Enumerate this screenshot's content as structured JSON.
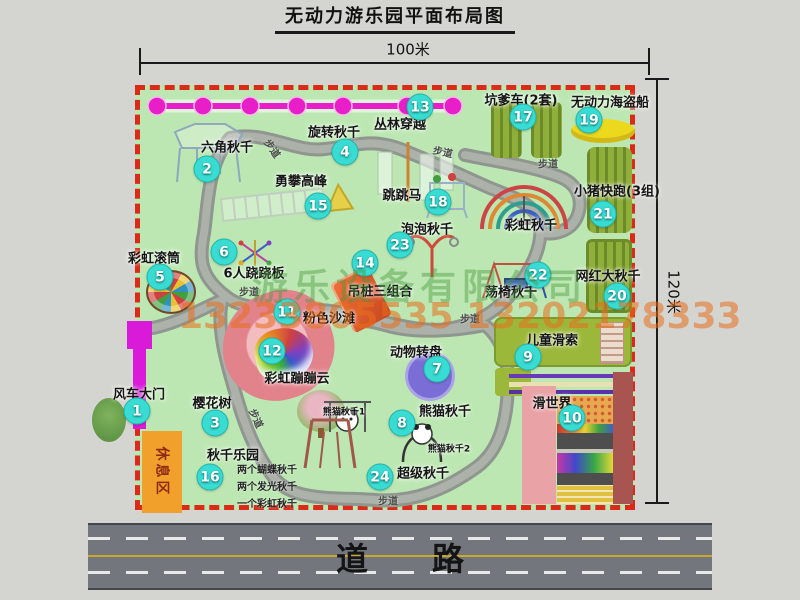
{
  "title": "无动力游乐园平面布局图",
  "dimension_labels": {
    "top": "100米",
    "right": "120米"
  },
  "road": {
    "label": "道路"
  },
  "walkway_label": "步道",
  "rest_area_label": "休息区",
  "rainbow_swing_label": "彩虹秋千",
  "panda_swing_sub_labels": [
    "熊猫秋千1",
    "熊猫秋千2"
  ],
  "swing_park_notes": [
    "两个蝴蝶秋千",
    "两个发光秋千",
    "一个彩虹秋千"
  ],
  "watermark": {
    "company": "游乐设备有限公司",
    "phone": "13233805535 13202178333"
  },
  "attractions": [
    {
      "num": "1",
      "name": "风车大门"
    },
    {
      "num": "2",
      "name": "六角秋千"
    },
    {
      "num": "3",
      "name": "樱花树"
    },
    {
      "num": "4",
      "name": "旋转秋千"
    },
    {
      "num": "5",
      "name": "彩虹滚筒"
    },
    {
      "num": "6",
      "name": "6人跷跷板"
    },
    {
      "num": "7",
      "name": "动物转盘"
    },
    {
      "num": "8",
      "name": "熊猫秋千"
    },
    {
      "num": "9",
      "name": "儿童滑索"
    },
    {
      "num": "10",
      "name": "滑世界"
    },
    {
      "num": "11",
      "name": "粉色沙滩"
    },
    {
      "num": "12",
      "name": "彩虹蹦蹦云"
    },
    {
      "num": "13",
      "name": "丛林穿越"
    },
    {
      "num": "14",
      "name": "吊桩三组合"
    },
    {
      "num": "15",
      "name": "勇攀高峰"
    },
    {
      "num": "16",
      "name": "秋千乐园"
    },
    {
      "num": "17",
      "name": "坑爹车(2套)"
    },
    {
      "num": "18",
      "name": "跳跳马"
    },
    {
      "num": "19",
      "name": "无动力海盗船"
    },
    {
      "num": "20",
      "name": "网红大秋千"
    },
    {
      "num": "21",
      "name": "小猪快跑(3组)"
    },
    {
      "num": "22",
      "name": "荡椅秋千"
    },
    {
      "num": "23",
      "name": "泡泡秋千"
    },
    {
      "num": "24",
      "name": "超级秋千"
    }
  ],
  "colors": {
    "map_bg": "#bce7b2",
    "border_red": "#dc2a18",
    "badge_cyan": "#38dcd2",
    "chain_magenta": "#e81fc8",
    "gate_magenta": "#d91ad9",
    "rest_orange": "#f2a02c",
    "equipment_olive": "#8fae3a",
    "pirate_ship_yellow": "#ecd91e",
    "carousel_purple": "#7a6ed6",
    "beach_pink": "#e2838c",
    "walkway_gray": "#9aa09a",
    "road_gray": "#73767c"
  }
}
